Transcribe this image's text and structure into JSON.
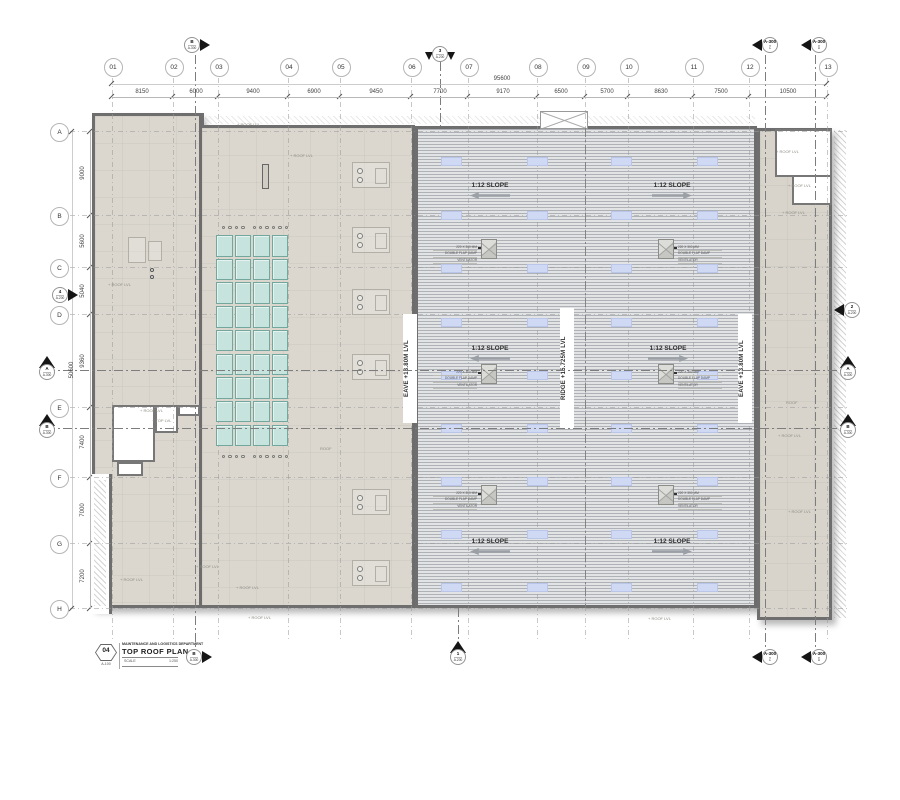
{
  "title_block": {
    "sheet_number": "04",
    "sheet_ref": "A-100",
    "department": "MAINTENANCE AND LOGISTICS DEPARTMENT",
    "title": "TOP ROOF PLAN",
    "scale_label": "SCALE",
    "scale_value": "1:250"
  },
  "overall_dims": {
    "top": "95600",
    "left": "50600"
  },
  "grid": {
    "columns": [
      {
        "id": "01",
        "x": 112
      },
      {
        "id": "02",
        "x": 173
      },
      {
        "id": "03",
        "x": 218
      },
      {
        "id": "04",
        "x": 288
      },
      {
        "id": "05",
        "x": 340
      },
      {
        "id": "06",
        "x": 411
      },
      {
        "id": "07",
        "x": 468
      },
      {
        "id": "08",
        "x": 537
      },
      {
        "id": "09",
        "x": 585
      },
      {
        "id": "10",
        "x": 628
      },
      {
        "id": "11",
        "x": 693
      },
      {
        "id": "12",
        "x": 749
      },
      {
        "id": "13",
        "x": 827
      }
    ],
    "rows": [
      {
        "id": "A",
        "y": 131
      },
      {
        "id": "B",
        "y": 215
      },
      {
        "id": "C",
        "y": 267
      },
      {
        "id": "D",
        "y": 314
      },
      {
        "id": "E",
        "y": 407
      },
      {
        "id": "F",
        "y": 477
      },
      {
        "id": "G",
        "y": 543
      },
      {
        "id": "H",
        "y": 608
      }
    ]
  },
  "top_dims": [
    {
      "v": "8150",
      "x": 142
    },
    {
      "v": "6000",
      "x": 196
    },
    {
      "v": "9400",
      "x": 253
    },
    {
      "v": "6900",
      "x": 314
    },
    {
      "v": "9450",
      "x": 376
    },
    {
      "v": "7700",
      "x": 440
    },
    {
      "v": "9170",
      "x": 503
    },
    {
      "v": "6500",
      "x": 561
    },
    {
      "v": "5700",
      "x": 607
    },
    {
      "v": "8630",
      "x": 661
    },
    {
      "v": "7500",
      "x": 721
    },
    {
      "v": "10500",
      "x": 788
    }
  ],
  "left_dims": [
    {
      "v": "9000",
      "y": 173
    },
    {
      "v": "5600",
      "y": 241
    },
    {
      "v": "5040",
      "y": 291
    },
    {
      "v": "9360",
      "y": 361
    },
    {
      "v": "7400",
      "y": 442
    },
    {
      "v": "7000",
      "y": 510
    },
    {
      "v": "7200",
      "y": 576
    }
  ],
  "levels": [
    {
      "text": "EAVE +13.80M LVL",
      "x": 403
    },
    {
      "text": "RIDGE +15.725M LVL",
      "x": 560
    },
    {
      "text": "EAVE +13.80M LVL",
      "x": 738
    }
  ],
  "slope": {
    "label": "1:12 SLOPE",
    "items": [
      {
        "x": 490,
        "y": 183,
        "dir": "left"
      },
      {
        "x": 672,
        "y": 183,
        "dir": "right"
      },
      {
        "x": 490,
        "y": 346,
        "dir": "left"
      },
      {
        "x": 668,
        "y": 346,
        "dir": "right"
      },
      {
        "x": 490,
        "y": 539,
        "dir": "left"
      },
      {
        "x": 672,
        "y": 539,
        "dir": "right"
      }
    ]
  },
  "ventilator": {
    "lines": [
      "220 X 300 MM",
      "DOUBLE FLAP DAMP",
      "VENTILATOR"
    ],
    "items": [
      {
        "x": 489,
        "y": 249,
        "side": "left"
      },
      {
        "x": 666,
        "y": 249,
        "side": "right"
      },
      {
        "x": 489,
        "y": 374,
        "side": "left"
      },
      {
        "x": 666,
        "y": 374,
        "side": "right"
      },
      {
        "x": 489,
        "y": 495,
        "side": "left"
      },
      {
        "x": 666,
        "y": 495,
        "side": "right"
      }
    ]
  },
  "skylights": {
    "teal": {
      "x": 216,
      "y": 235,
      "cols": 4,
      "rows": 9,
      "cw": 18.5,
      "rh": 23.7
    },
    "strips": {
      "cols": [
        441,
        527,
        611,
        697
      ],
      "rows": [
        157,
        211,
        264,
        318,
        371,
        424,
        477,
        530,
        583
      ],
      "w": 21,
      "h": 9
    }
  },
  "markers": [
    {
      "top": "B",
      "bottom": "A-300",
      "x": 195,
      "y": 45,
      "dir": "right"
    },
    {
      "top": "3",
      "bottom": "A-200",
      "x": 440,
      "y": 55,
      "dir": "down"
    },
    {
      "top": "A-300",
      "bottom": "C",
      "x": 767,
      "y": 45,
      "dir": "left"
    },
    {
      "top": "A-300",
      "bottom": "D",
      "x": 816,
      "y": 45,
      "dir": "left"
    },
    {
      "top": "4",
      "bottom": "A-200",
      "x": 63,
      "y": 295,
      "dir": "right"
    },
    {
      "top": "A",
      "bottom": "A-300",
      "x": 47,
      "y": 370,
      "dir": "up"
    },
    {
      "top": "B",
      "bottom": "A-300",
      "x": 47,
      "y": 428,
      "dir": "up"
    },
    {
      "top": "2",
      "bottom": "A-200",
      "x": 849,
      "y": 310,
      "dir": "left"
    },
    {
      "top": "A",
      "bottom": "A-300",
      "x": 848,
      "y": 370,
      "dir": "up"
    },
    {
      "top": "B",
      "bottom": "A-300",
      "x": 848,
      "y": 428,
      "dir": "up"
    },
    {
      "top": "1",
      "bottom": "A-200",
      "x": 458,
      "y": 655,
      "dir": "up"
    },
    {
      "top": "B",
      "bottom": "A-300",
      "x": 197,
      "y": 657,
      "dir": "right"
    },
    {
      "top": "A-300",
      "bottom": "C",
      "x": 767,
      "y": 657,
      "dir": "left"
    },
    {
      "top": "A-300",
      "bottom": "D",
      "x": 816,
      "y": 657,
      "dir": "left"
    }
  ],
  "notes": [
    {
      "x": 237,
      "y": 123,
      "text": "+ ROOF LVL"
    },
    {
      "x": 290,
      "y": 154,
      "text": "+ ROOF LVL"
    },
    {
      "x": 108,
      "y": 283,
      "text": "+ ROOF LVL"
    },
    {
      "x": 140,
      "y": 409,
      "text": "+ ROOF LVL"
    },
    {
      "x": 152,
      "y": 419,
      "text": "+ TOP LVL"
    },
    {
      "x": 196,
      "y": 565,
      "text": "+ ROOF LVL"
    },
    {
      "x": 120,
      "y": 578,
      "text": "+ ROOF LVL"
    },
    {
      "x": 236,
      "y": 586,
      "text": "+ ROOF LVL"
    },
    {
      "x": 320,
      "y": 447,
      "text": "ROOF"
    },
    {
      "x": 248,
      "y": 616,
      "text": "+ ROOF LVL"
    },
    {
      "x": 648,
      "y": 617,
      "text": "+ ROOF LVL"
    },
    {
      "x": 776,
      "y": 150,
      "text": "+ ROOF LVL"
    },
    {
      "x": 788,
      "y": 184,
      "text": "+ ROOF LVL"
    },
    {
      "x": 782,
      "y": 211,
      "text": "+ ROOF LVL"
    },
    {
      "x": 786,
      "y": 401,
      "text": "ROOF"
    },
    {
      "x": 778,
      "y": 434,
      "text": "+ ROOF LVL"
    },
    {
      "x": 788,
      "y": 510,
      "text": "+ ROOF LVL"
    }
  ],
  "equipment": [
    {
      "x": 352,
      "y": 162
    },
    {
      "x": 352,
      "y": 227
    },
    {
      "x": 352,
      "y": 289
    },
    {
      "x": 352,
      "y": 354
    },
    {
      "x": 352,
      "y": 489
    },
    {
      "x": 352,
      "y": 560
    }
  ],
  "colors": {
    "wall": "#6e6e6e",
    "flat_roof": "#dbd7cf",
    "flat_roof_right": "#d8d4cc",
    "metal_dark": "#aeb1b5",
    "metal_light": "#e2e3e5",
    "teal_fill": "#c6e3dd",
    "teal_border": "#72a79e",
    "strip_fill": "#cfd9f3",
    "strip_border": "#bac6e9",
    "dim_text": "#444444",
    "line": "#9a9a9a"
  }
}
